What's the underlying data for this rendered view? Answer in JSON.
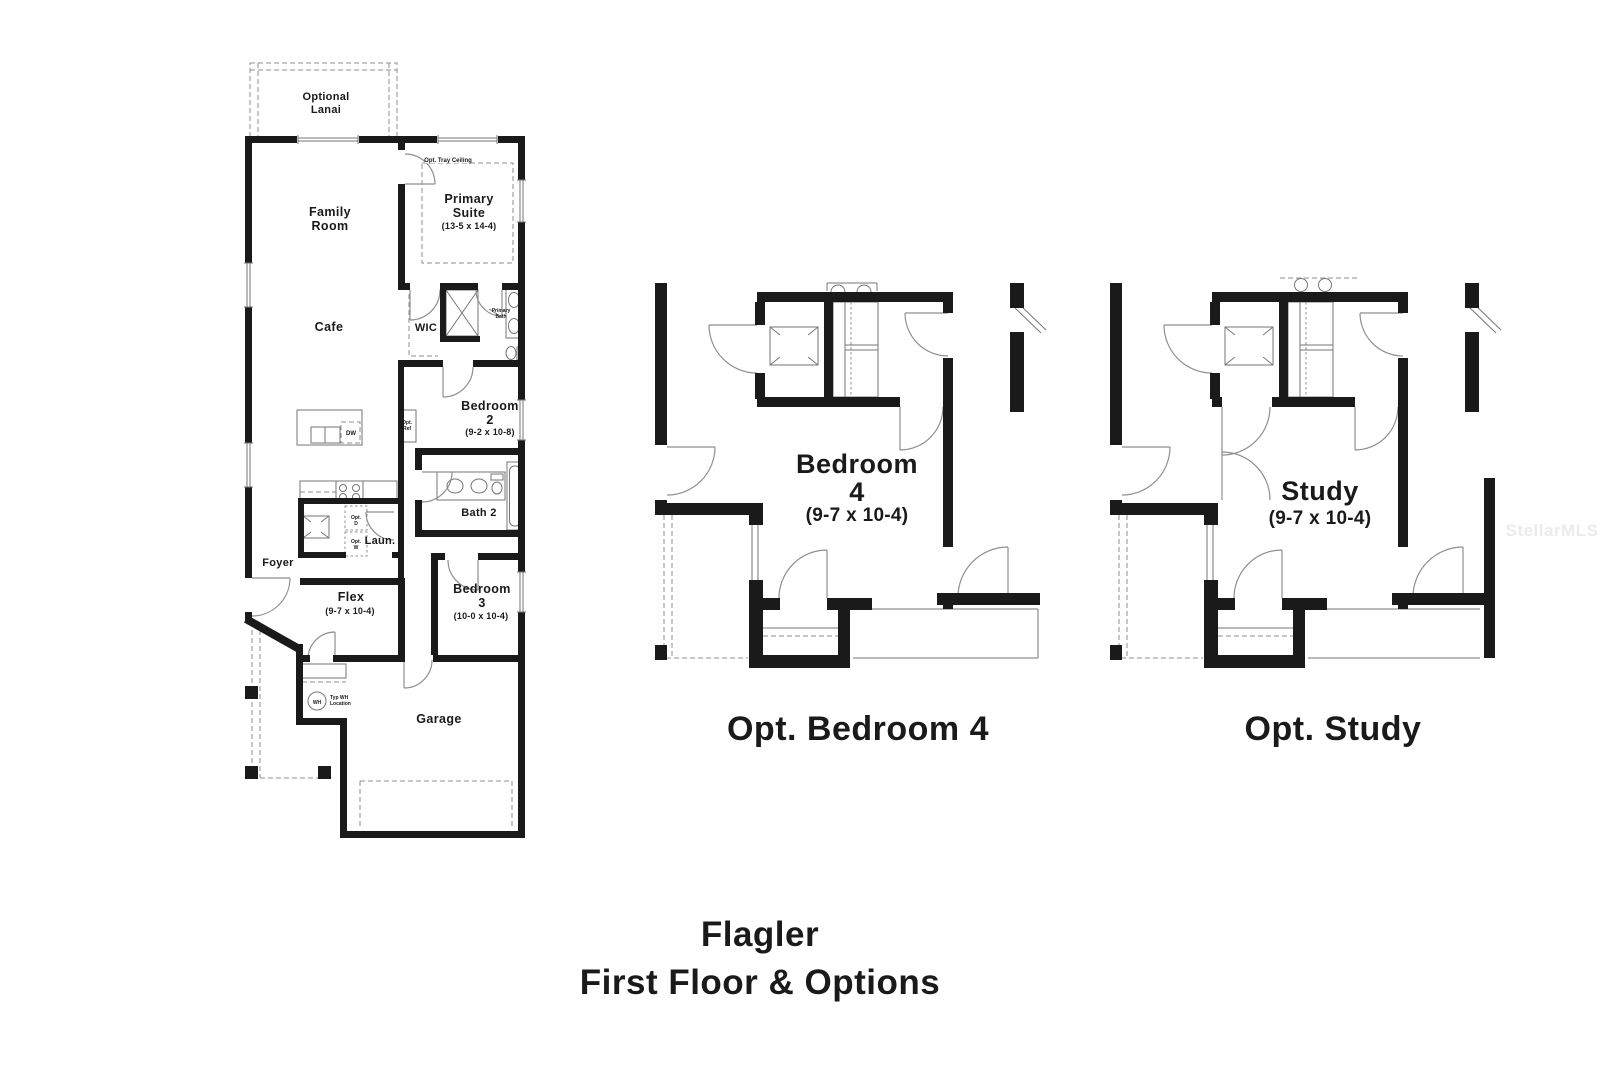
{
  "title": {
    "line1": "Flagler",
    "line2": "First Floor & Options"
  },
  "watermark": "StellarMLS",
  "colors": {
    "wall": "#1a1a1a",
    "thin_line": "#767676",
    "dashed_line": "#8f8f8f",
    "text": "#1a1a1a",
    "watermark": "#ebebeb",
    "background": "#ffffff"
  },
  "main_plan": {
    "lanai_line1": "Optional",
    "lanai_line2": "Lanai",
    "family_line1": "Family",
    "family_line2": "Room",
    "primary_line1": "Primary",
    "primary_line2": "Suite",
    "primary_dims": "(13-5 x 14-4)",
    "tray_ceiling": "Opt. Tray Ceiling",
    "cafe": "Cafe",
    "wic": "WIC",
    "primary_bath_line1": "Primary",
    "primary_bath_line2": "Bath",
    "bedroom2_line1": "Bedroom",
    "bedroom2_line2": "2",
    "bedroom2_dims": "(9-2 x 10-8)",
    "opt_ref_line1": "Opt.",
    "opt_ref_line2": "Ref",
    "dw": "DW",
    "bath2": "Bath 2",
    "laundry": "Laun.",
    "opt_d_line1": "Opt.",
    "opt_d_line2": "D",
    "opt_w_line1": "Opt.",
    "opt_w_line2": "W",
    "foyer": "Foyer",
    "flex": "Flex",
    "flex_dims": "(9-7 x 10-4)",
    "bedroom3_line1": "Bedroom",
    "bedroom3_line2": "3",
    "bedroom3_dims": "(10-0 x 10-4)",
    "garage": "Garage",
    "wh": "WH",
    "wh_note_line1": "Typ WH",
    "wh_note_line2": "Location"
  },
  "opt_bedroom4": {
    "caption": "Opt. Bedroom 4",
    "room_line1": "Bedroom",
    "room_line2": "4",
    "room_dims": "(9-7 x 10-4)"
  },
  "opt_study": {
    "caption": "Opt. Study",
    "room": "Study",
    "room_dims": "(9-7 x 10-4)"
  }
}
